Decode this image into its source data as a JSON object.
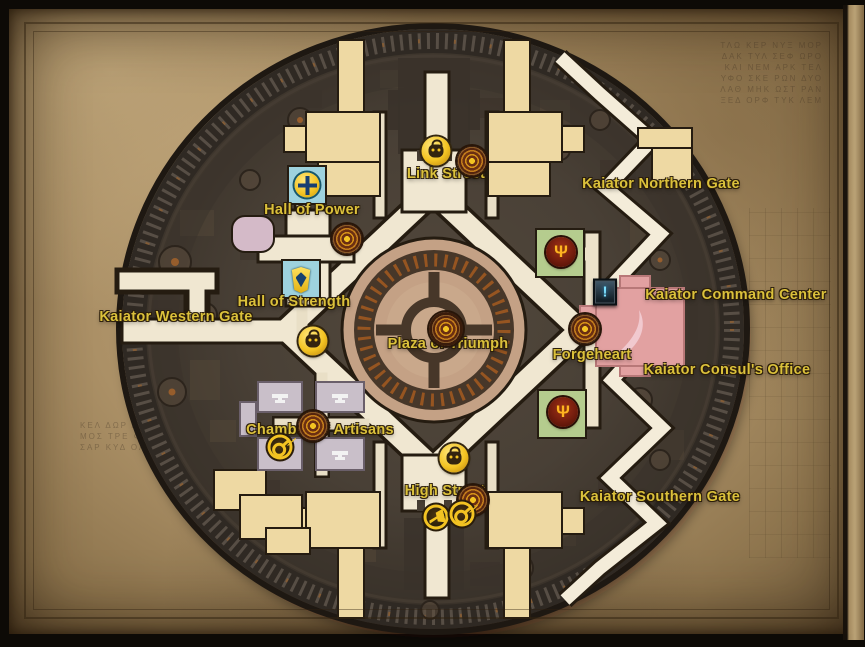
{
  "labels": {
    "link_street": "Link Street",
    "northern_gate": "Kaiator Northern Gate",
    "hall_of_power": "Hall of Power",
    "command_center": "Kaiator Command Center",
    "hall_of_strength": "Hall of Strength",
    "western_gate": "Kaiator Western Gate",
    "plaza_of_triumph": "Plaza of Triumph",
    "forgeheart": "Forgeheart",
    "consuls_office": "Kaiator Consul's Office",
    "chamber_of_artisans": "Chamber of Artisans",
    "high_street": "High Street",
    "southern_gate": "Kaiator Southern Gate"
  },
  "icon_glyphs": {
    "quest": "!",
    "flight_master": "Ψ"
  },
  "icon_names": {
    "merchant": "gold disc with coin pouch",
    "key_merchant": "gold ring with key",
    "crier": "gold ring with horn",
    "campfire": "bronze concentric rings marker",
    "plaza_marker": "large bronze rings marker",
    "flight_master": "dark red disc with gold wings",
    "quest": "blue exclamation plaque",
    "hall_of_power": "cyan plaque with gold compass emblem",
    "hall_of_strength": "cyan plaque with gold shield emblem",
    "anvil": "white anvil on workshop roof"
  },
  "decor": {
    "runes_top_right": "ΤΛΩ ΚΕΡ ΝΥΞ ΜΟΡ\nΔΑΚ ΤΥΛ ΣΕΦ ΩΡΟ\nΚΑΙ ΝΕΜ ΑΡΚ ΤΕΛ\nΥΦΟ ΣΚΕ ΡΩΝ ΔΥΟ\nΛΑΘ ΜΗΚ ΩΣΤ ΡΑΝ\nΞΕΔ ΟΡΦ ΤΥΚ ΛΕΜ",
    "runes_bottom_left": "ΚΕΛ ΔΩΡ ΑΝΥ\nΜΟΣ ΤΡΕ ΦΩΝ\nΣΑΡ ΚΥΔ ΟΛΜ"
  },
  "colors": {
    "label_gold": "#dbc13b",
    "road_cream": "#f0e7d1",
    "city_dark": "#463d33",
    "wall": "#332c26",
    "plaza_tan": "#c4a185",
    "building_wheat": "#eed9a3",
    "building_lavender": "#c9bfc9",
    "building_green": "#b5cc8e",
    "building_pink": "#e2a1a1",
    "plaque_cyan": "#9ed2de",
    "icon_gold": "#f3c322",
    "marker_bronze": "#6b2f12",
    "flight_red": "#7a1f14",
    "quest_blue": "#7ce0ff",
    "parchment": "#ab9066"
  }
}
